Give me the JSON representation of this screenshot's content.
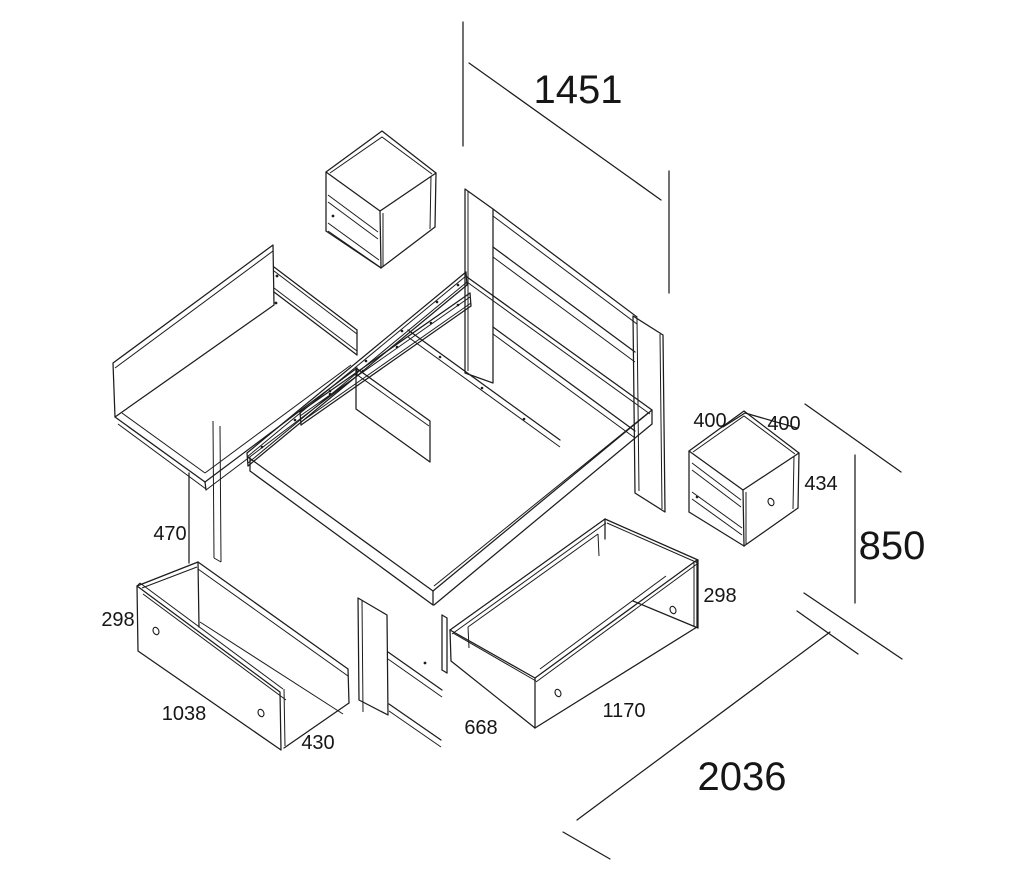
{
  "diagram": {
    "kind": "exploded-isometric-assembly-drawing",
    "subject": "storage bed with two drawers, shelf compartments and two nightstands",
    "line_color": "#1c1c1c",
    "background_color": "#ffffff"
  },
  "dims": {
    "headboard_width": "1451",
    "overall_height": "850",
    "overall_length": "2036",
    "base_height": "470",
    "nightstand_width": "400",
    "nightstand_depth": "400",
    "nightstand_height": "434",
    "left_drawer_height": "298",
    "left_drawer_length": "1038",
    "left_drawer_depth": "430",
    "right_drawer_width": "668",
    "right_drawer_length": "1170",
    "right_drawer_height": "298"
  }
}
